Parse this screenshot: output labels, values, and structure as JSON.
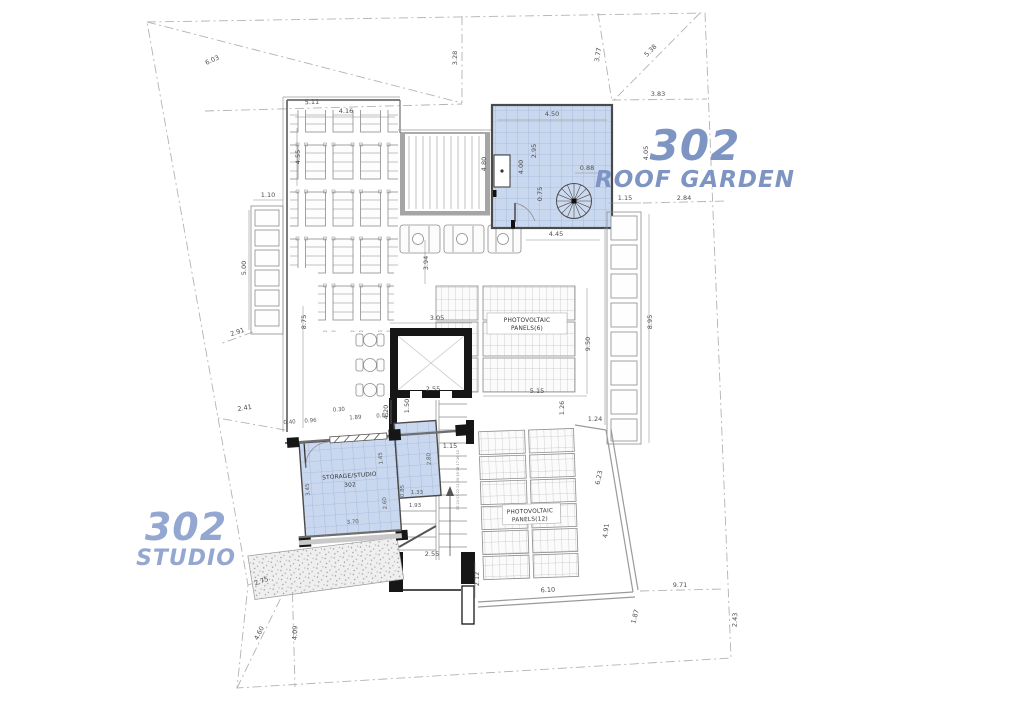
{
  "titles": {
    "roof_garden": {
      "number": "302",
      "name": "ROOF GARDEN"
    },
    "studio": {
      "number": "302",
      "name": "STUDIO"
    }
  },
  "rooms": {
    "storage_studio_name": "STORAGE/STUDIO",
    "storage_studio_number": "302",
    "pv_upper_line1": "PHOTOVOLTAIC",
    "pv_upper_line2": "PANELS(6)",
    "pv_lower_line1": "PHOTOVOLTAIC",
    "pv_lower_line2": "PANELS(12)"
  },
  "stairs": {
    "step_numbers": "25·24·23·22·21·20·19·18·17·16·15"
  },
  "dims": {
    "site_diag_tl": "6.03",
    "site_tl_lower": "5.11",
    "site_top_v": "3.28",
    "site_tr_left": "3.77",
    "site_tr_diag": "5.38",
    "site_tr_h": "3.83",
    "site_right_h": "2.84",
    "site_left_tie1": "2.91",
    "site_left_tie2": "2.41",
    "site_bl_d1": "2.75",
    "site_bl_diag": "4.60",
    "site_bl_v": "4.09",
    "site_br_h": "9.71",
    "site_br_v": "2.43",
    "site_br_small": "1.87",
    "pergola_top": "4.16",
    "loungers_v": "4.55",
    "planter_left_top": "1.10",
    "planter_left_v": "5.00",
    "terrace_left_v": "8.75",
    "mid_v": "3.94",
    "planter_row_r": "4.45",
    "roof_garden_top": "4.50",
    "rg_inner_v1": "2.95",
    "rg_inner_v2": "4.00",
    "rg_left_v": "4.80",
    "rg_right_v": "4.05",
    "rg_stair_w": "0.88",
    "rg_stair_h": "0.75",
    "planter_right_top": "1.15",
    "planter_right_v": "8.95",
    "elevator_top": "3.05",
    "elevator_bottom": "2.55",
    "elevator_inner_v": "1.50",
    "stair_left_v": "4.20",
    "pv_upper_right_v": "9.50",
    "pv_upper_bottom": "5.15",
    "pv_gap_v": "1.26",
    "pv_gap_h": "1.24",
    "studio_d1": "0.40",
    "studio_d2": "0.96",
    "studio_d3": "0.30",
    "studio_d4": "1.89",
    "studio_d5": "0.80",
    "studio_left_v": "3.45",
    "studio_inner_v1": "1.45",
    "studio_annex_v": "2.80",
    "studio_inner_v2": "2.60",
    "studio_bottom": "3.70",
    "stair_d_133": "1.33",
    "stair_d_085": "0.85",
    "stair_d_193": "1.93",
    "stair_bottom": "2.55",
    "annex_right": "1.15",
    "stair_bottom_v": "2.12",
    "pv_lower_diag": "6.23",
    "pv_lower_right_v": "4.91",
    "parapet_bottom": "6.10"
  },
  "colors": {
    "accent_blue_title": "#7e95c3",
    "accent_blue_title_light": "#93a7d0",
    "room_fill": "#c9d8ef",
    "room_grid": "#8fa8d2",
    "wall_dark": "#161616",
    "wall_gray": "#a0a0a0",
    "dim_text": "#4f4f4f",
    "boundary": "#b3b3b3"
  }
}
